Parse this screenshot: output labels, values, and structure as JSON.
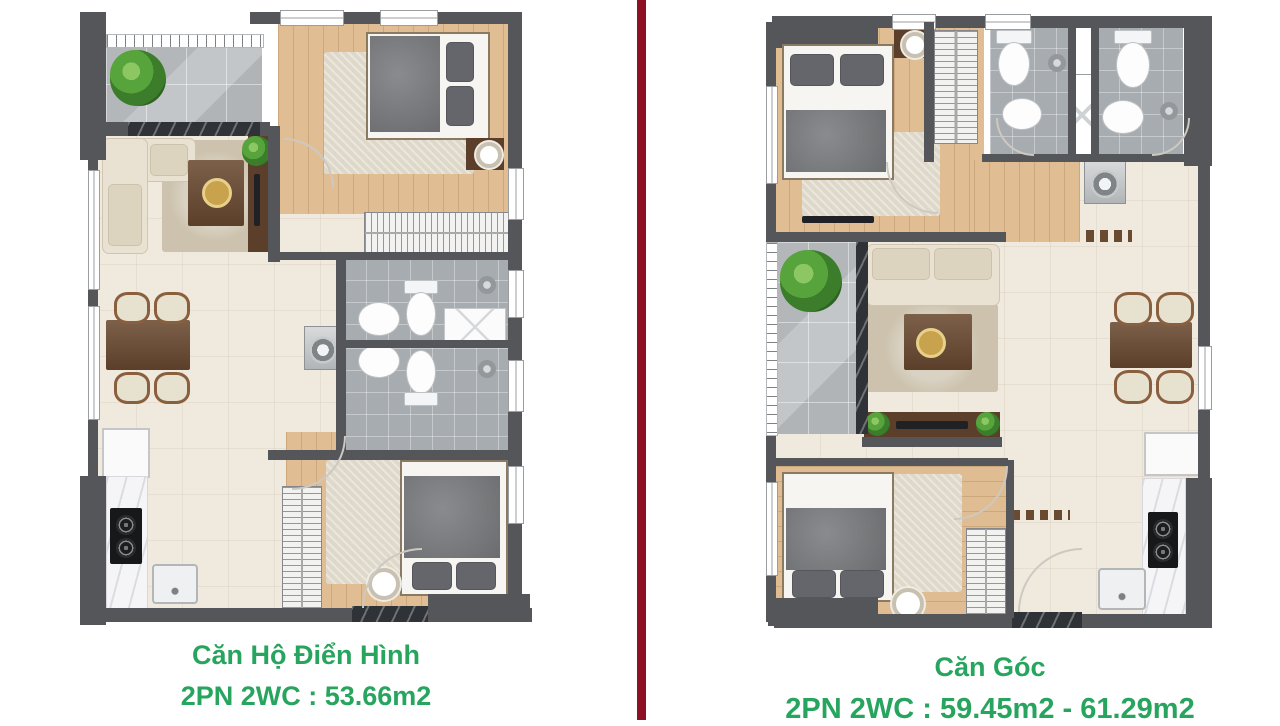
{
  "captions": {
    "left": {
      "title": "Căn Hộ Điển Hình",
      "spec": "2PN 2WC : 53.66m2"
    },
    "right": {
      "title": "Căn Góc",
      "spec": "2PN 2WC : 59.45m2 - 61.29m2"
    }
  },
  "colors": {
    "caption_green": "#27a55e",
    "divider_red": "#8e1023",
    "wall_gray": "#55565a"
  }
}
